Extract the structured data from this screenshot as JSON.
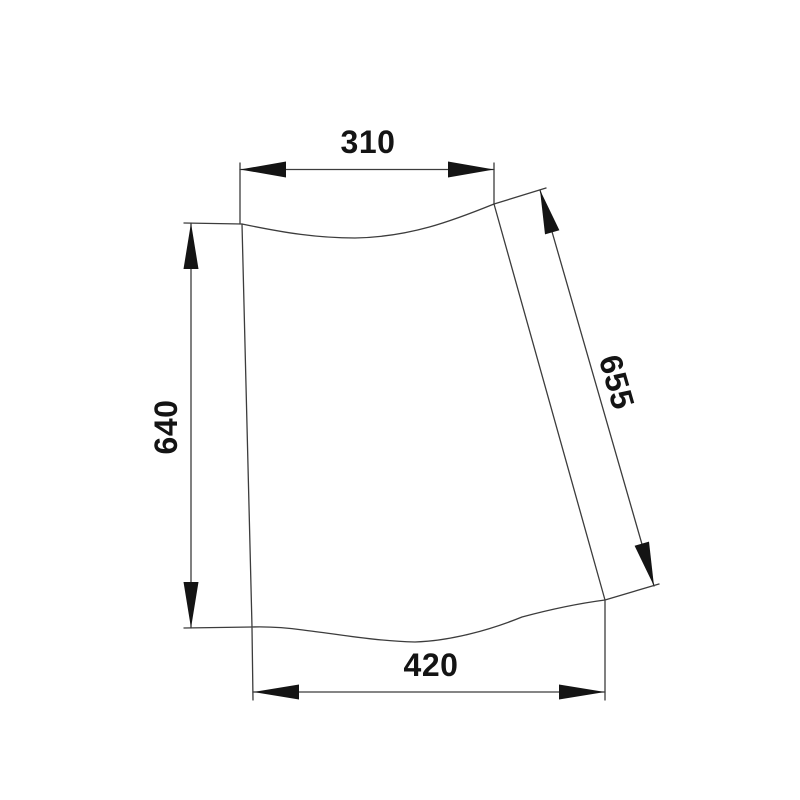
{
  "page": {
    "background": "#ffffff"
  },
  "drawing": {
    "colors": {
      "line": "#3c3c3c",
      "ink": "#141414"
    },
    "labels": {
      "top_width": "310",
      "left_height": "640",
      "right_edge_length": "655",
      "bottom_width": "420"
    }
  }
}
